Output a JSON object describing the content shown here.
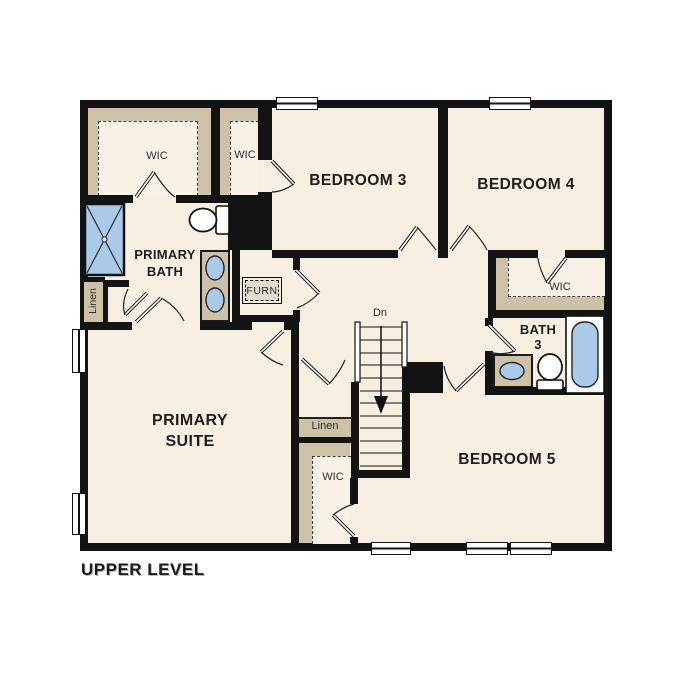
{
  "title": "UPPER LEVEL",
  "floor_plan": {
    "rooms": {
      "bedroom_3": "BEDROOM 3",
      "bedroom_4": "BEDROOM 4",
      "bedroom_5": "BEDROOM 5",
      "primary_suite_line1": "PRIMARY",
      "primary_suite_line2": "SUITE",
      "primary_bath_line1": "PRIMARY",
      "primary_bath_line2": "BATH",
      "bath_3_line1": "BATH",
      "bath_3_line2": "3"
    },
    "closets": {
      "primary_wic": "WIC",
      "bedroom_3_wic": "WIC",
      "bedroom_4_wic": "WIC",
      "bedroom_5_wic": "WIC",
      "hall_linen": "Linen",
      "primary_linen": "Linen"
    },
    "stairs_label": "Dn",
    "furnace_label": "FURN"
  },
  "colors": {
    "floor": "#f6efe2",
    "shelf_tan": "#cdc1a8",
    "wall": "#131313",
    "fixture_blue": "#abc9e8"
  }
}
